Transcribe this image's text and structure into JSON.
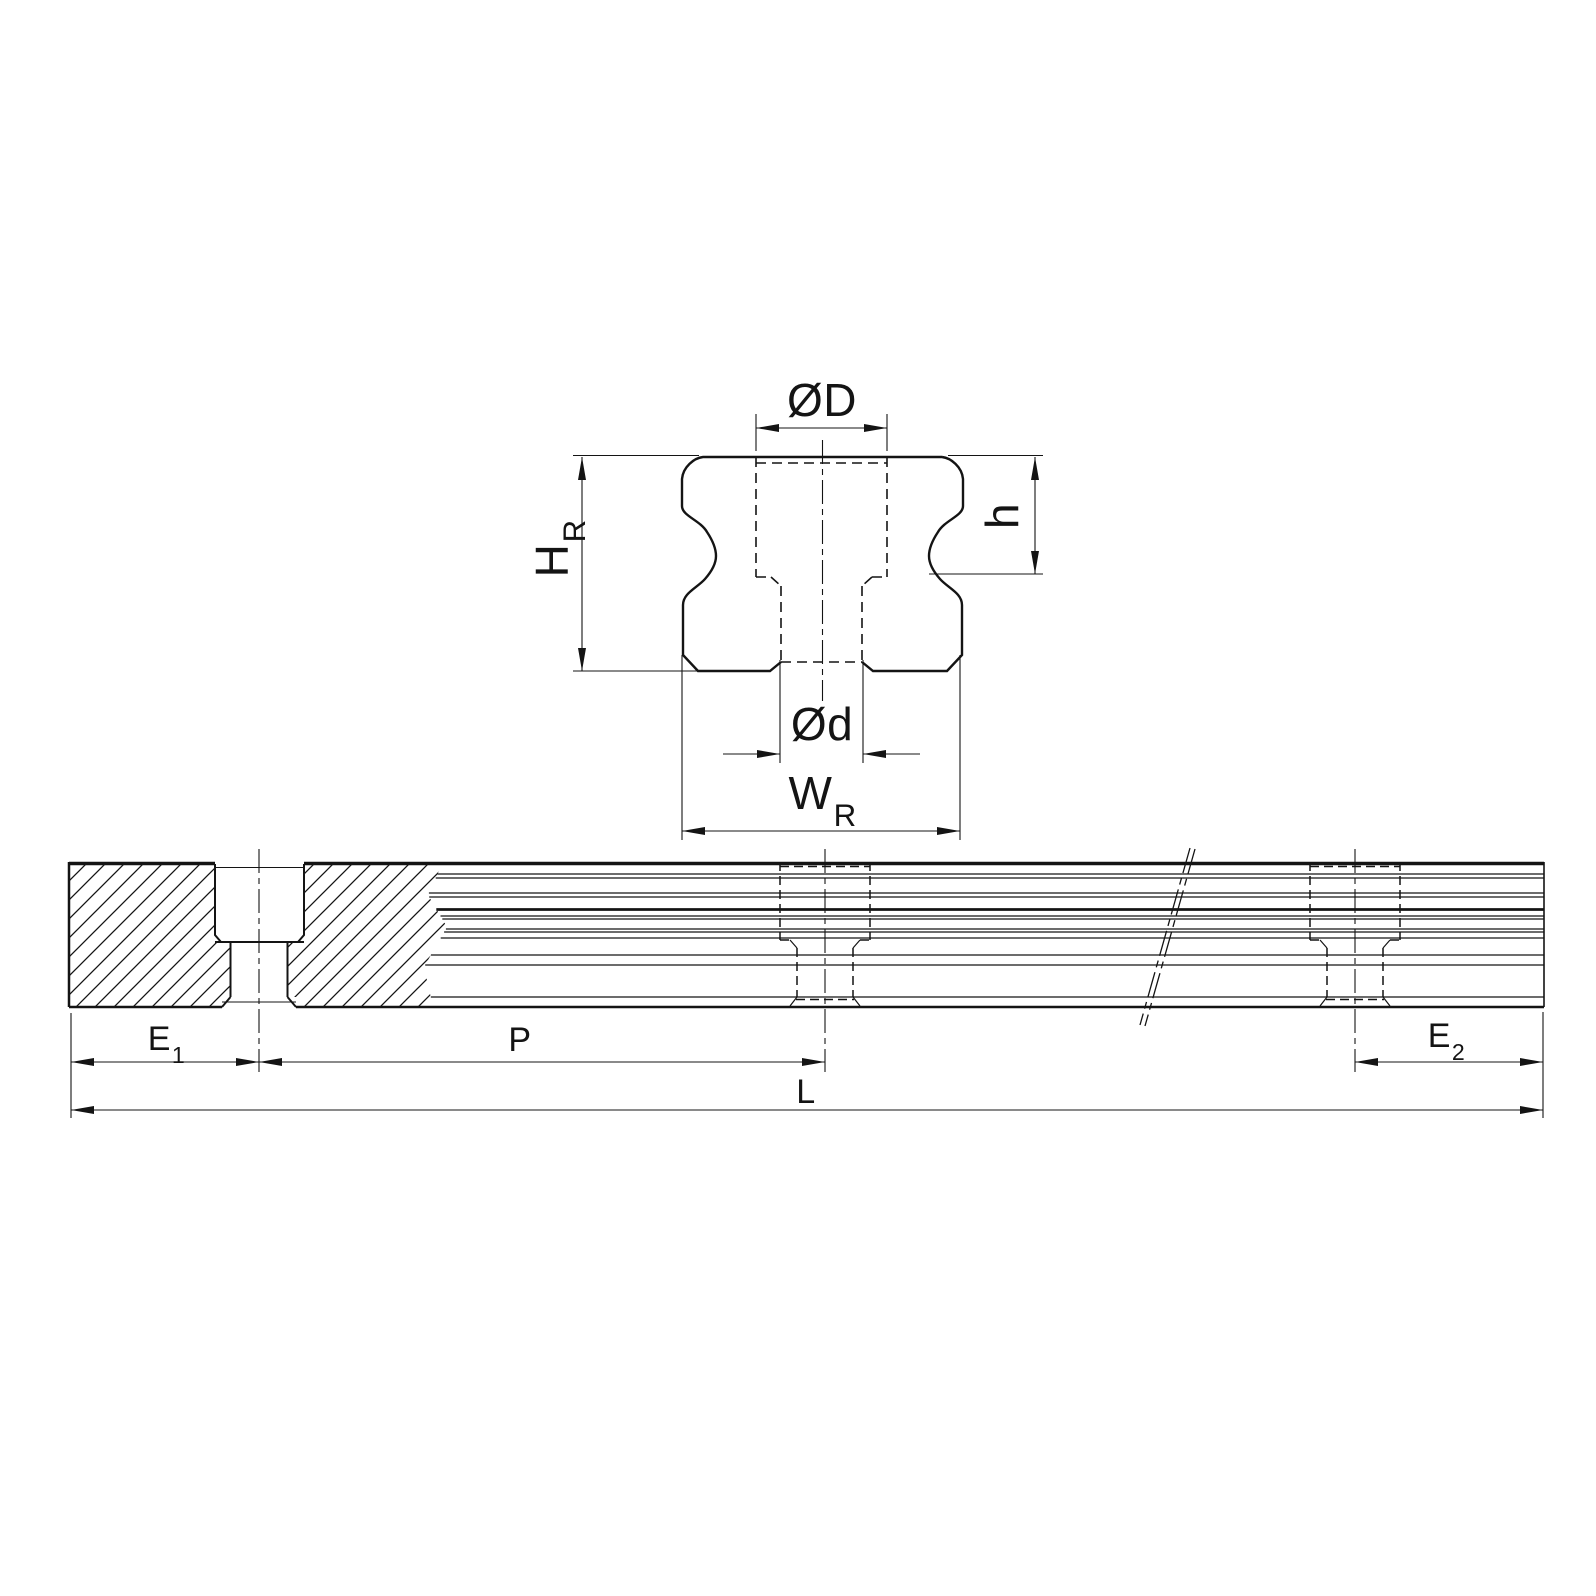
{
  "drawing": {
    "description": "Linear guide rail engineering drawing with cross-section profile view and side elevation view",
    "colors": {
      "line": "#141414",
      "background": "#ffffff"
    },
    "cross_section": {
      "labels": {
        "counterbore_diameter": {
          "base": "ØD",
          "sub": ""
        },
        "rail_height": {
          "base": "H",
          "sub": "R"
        },
        "counterbore_depth": {
          "base": "h",
          "sub": ""
        },
        "bolt_hole_diameter": {
          "base": "Ød",
          "sub": ""
        },
        "rail_width": {
          "base": "W",
          "sub": "R"
        }
      }
    },
    "side_view": {
      "labels": {
        "edge_distance_left": {
          "base": "E",
          "sub": "1"
        },
        "hole_pitch": {
          "base": "P",
          "sub": ""
        },
        "edge_distance_right": {
          "base": "E",
          "sub": "2"
        },
        "total_length": {
          "base": "L",
          "sub": ""
        }
      }
    }
  }
}
